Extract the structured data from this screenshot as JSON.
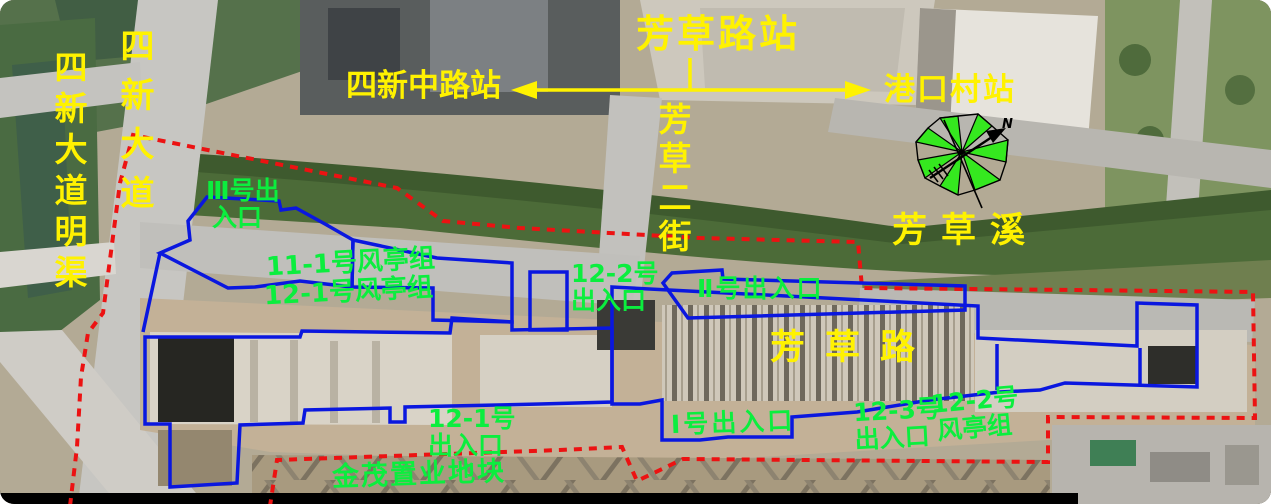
{
  "map": {
    "title_station": "芳草路站",
    "stations": {
      "current": "芳草路站",
      "west_adjacent": "四新中路站",
      "east_adjacent": "港口村站"
    },
    "roads": {
      "sixin_avenue": "四新大道",
      "sixin_avenue_open_channel": "四新大道明渠",
      "fangcao_2nd_street": "芳草二街",
      "fangcao_road": "芳草路",
      "fangcao_creek": "芳草溪"
    },
    "site_labels": {
      "exit_3_line1": "Ⅲ号出",
      "exit_3_line2": "入口",
      "vent_11_1": "11-1号风亭组",
      "vent_12_1": "12-1号风亭组",
      "exit_12_2_line1": "12-2号",
      "exit_12_2_line2": "出入口",
      "exit_2": "Ⅱ号出入口",
      "exit_1": "Ⅰ号出入口",
      "exit_12_3_line1": "12-3号",
      "exit_12_3_line2": "出入口",
      "vent_12_2_line1": "12-2号",
      "vent_12_2_line2": "风亭组",
      "exit_12_1_line1": "12-1号",
      "exit_12_1_line2": "出入口",
      "jinmao_plot": "金茂置业地块"
    },
    "compass": {
      "north_label": "N"
    },
    "colors": {
      "station_label": "#fff200",
      "site_label": "#0bee3e",
      "red_boundary": "#ec1212",
      "blue_structure_outline": "#0a17df",
      "arrow": "#fff200"
    }
  }
}
